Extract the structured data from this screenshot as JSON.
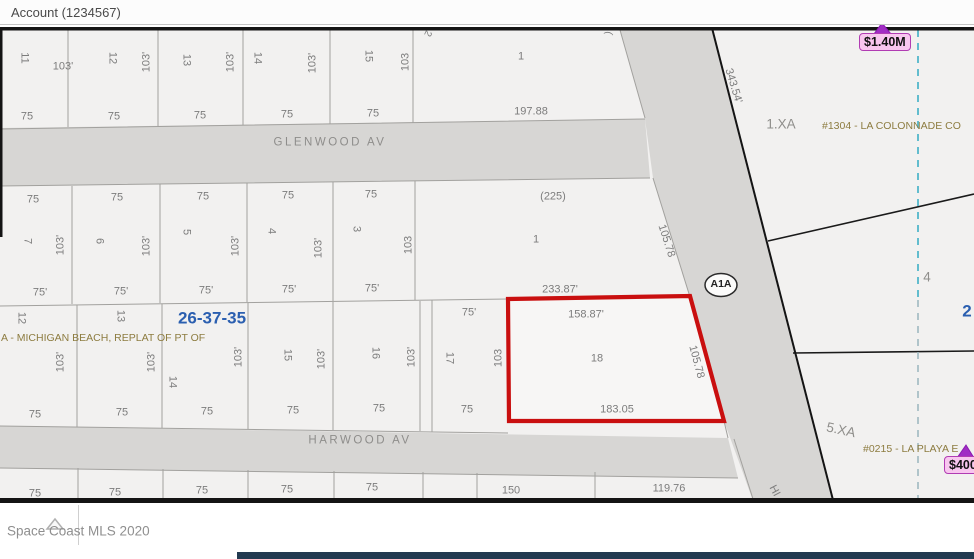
{
  "header": {
    "account_label": "Account (1234567)"
  },
  "footer": {
    "watermark": "Space Coast MLS 2020"
  },
  "map": {
    "shield_label": "A1A",
    "price_markers": [
      {
        "label": "$1.40M"
      },
      {
        "label": "$400"
      }
    ],
    "colors": {
      "parcel_highlight": "#c90f0f",
      "section_blue": "#2b5fb0",
      "plat_olive": "#8d7c40",
      "marker_pink": "#f8c6ef",
      "marker_border": "#b13cb3",
      "road_gray": "#d7d6d4",
      "navy_bar": "#223a50",
      "dashed_line_teal": "#4aafc0"
    },
    "highlighted_parcel": {
      "lot": "18",
      "front": "158.87'",
      "rear": "183.05",
      "side_east": "105.78",
      "side_west": "103"
    },
    "labels": [
      {
        "t": "11",
        "x": 24,
        "y": 58,
        "r": 90
      },
      {
        "t": "12",
        "x": 112,
        "y": 58,
        "r": 90
      },
      {
        "t": "13",
        "x": 186,
        "y": 60,
        "r": 90
      },
      {
        "t": "14",
        "x": 257,
        "y": 58,
        "r": 90
      },
      {
        "t": "15",
        "x": 368,
        "y": 56,
        "r": 90
      },
      {
        "t": "1",
        "x": 521,
        "y": 57
      },
      {
        "t": "103'",
        "x": 63,
        "y": 67
      },
      {
        "t": "103'",
        "x": 147,
        "y": 62,
        "r": -90
      },
      {
        "t": "103'",
        "x": 231,
        "y": 62,
        "r": -90
      },
      {
        "t": "103'",
        "x": 313,
        "y": 63,
        "r": -90
      },
      {
        "t": "103",
        "x": 406,
        "y": 62,
        "r": -90
      },
      {
        "t": "75",
        "x": 27,
        "y": 117
      },
      {
        "t": "75",
        "x": 114,
        "y": 117
      },
      {
        "t": "75",
        "x": 200,
        "y": 116
      },
      {
        "t": "75",
        "x": 287,
        "y": 115
      },
      {
        "t": "75",
        "x": 373,
        "y": 114
      },
      {
        "t": "197.88",
        "x": 531,
        "y": 112
      },
      {
        "t": "2",
        "x": 427,
        "y": 33,
        "r": 115,
        "c": "cut"
      },
      {
        "t": "(",
        "x": 608,
        "y": 33,
        "r": 100,
        "c": "cut"
      },
      {
        "t": "GLENWOOD AV",
        "x": 330,
        "y": 143,
        "c": "street"
      },
      {
        "t": "75",
        "x": 33,
        "y": 200
      },
      {
        "t": "75",
        "x": 117,
        "y": 198
      },
      {
        "t": "75",
        "x": 203,
        "y": 197
      },
      {
        "t": "75",
        "x": 288,
        "y": 196
      },
      {
        "t": "75",
        "x": 371,
        "y": 195
      },
      {
        "t": "(225)",
        "x": 553,
        "y": 197
      },
      {
        "t": "7",
        "x": 27,
        "y": 241,
        "r": 90
      },
      {
        "t": "6",
        "x": 99,
        "y": 241,
        "r": 90
      },
      {
        "t": "5",
        "x": 186,
        "y": 232,
        "r": 90
      },
      {
        "t": "4",
        "x": 271,
        "y": 231,
        "r": 90
      },
      {
        "t": "3",
        "x": 356,
        "y": 229,
        "r": 90
      },
      {
        "t": "1",
        "x": 536,
        "y": 240
      },
      {
        "t": "103'",
        "x": 61,
        "y": 245,
        "r": -90
      },
      {
        "t": "103'",
        "x": 147,
        "y": 246,
        "r": -90
      },
      {
        "t": "103'",
        "x": 236,
        "y": 246,
        "r": -90
      },
      {
        "t": "103'",
        "x": 319,
        "y": 248,
        "r": -90
      },
      {
        "t": "103",
        "x": 409,
        "y": 245,
        "r": -90
      },
      {
        "t": "75'",
        "x": 40,
        "y": 293
      },
      {
        "t": "75'",
        "x": 121,
        "y": 292
      },
      {
        "t": "75'",
        "x": 206,
        "y": 291
      },
      {
        "t": "75'",
        "x": 289,
        "y": 290
      },
      {
        "t": "75'",
        "x": 372,
        "y": 289
      },
      {
        "t": "233.87'",
        "x": 560,
        "y": 290
      },
      {
        "t": "105.78",
        "x": 666,
        "y": 241,
        "r": 72
      },
      {
        "t": "75'",
        "x": 469,
        "y": 313
      },
      {
        "t": "12",
        "x": 21,
        "y": 318,
        "r": 90
      },
      {
        "t": "13",
        "x": 120,
        "y": 316,
        "r": 90
      },
      {
        "t": "14",
        "x": 172,
        "y": 382,
        "r": 90
      },
      {
        "t": "15",
        "x": 287,
        "y": 355,
        "r": 90
      },
      {
        "t": "16",
        "x": 375,
        "y": 353,
        "r": 90
      },
      {
        "t": "17",
        "x": 449,
        "y": 358,
        "r": 90
      },
      {
        "t": "103'",
        "x": 61,
        "y": 362,
        "r": -90
      },
      {
        "t": "103'",
        "x": 152,
        "y": 362,
        "r": -90
      },
      {
        "t": "103'",
        "x": 239,
        "y": 357,
        "r": -90
      },
      {
        "t": "103'",
        "x": 322,
        "y": 359,
        "r": -90
      },
      {
        "t": "103'",
        "x": 412,
        "y": 357,
        "r": -90
      },
      {
        "t": "103",
        "x": 499,
        "y": 358,
        "r": -90
      },
      {
        "t": "26-37-35",
        "x": 212,
        "y": 318,
        "c": "section"
      },
      {
        "t": "A - MICHIGAN BEACH, REPLAT OF PT OF",
        "x": 1,
        "y": 338,
        "c": "plat",
        "a": "l"
      },
      {
        "t": "158.87'",
        "x": 586,
        "y": 315
      },
      {
        "t": "18",
        "x": 597,
        "y": 359
      },
      {
        "t": "183.05",
        "x": 617,
        "y": 410
      },
      {
        "t": "105.78",
        "x": 696,
        "y": 362,
        "r": 75
      },
      {
        "t": "75",
        "x": 35,
        "y": 415
      },
      {
        "t": "75",
        "x": 122,
        "y": 413
      },
      {
        "t": "75",
        "x": 207,
        "y": 412
      },
      {
        "t": "75",
        "x": 293,
        "y": 411
      },
      {
        "t": "75",
        "x": 379,
        "y": 409
      },
      {
        "t": "75",
        "x": 467,
        "y": 410
      },
      {
        "t": "HARWOOD AV",
        "x": 360,
        "y": 441,
        "c": "street"
      },
      {
        "t": "75",
        "x": 35,
        "y": 494
      },
      {
        "t": "75",
        "x": 115,
        "y": 493
      },
      {
        "t": "75",
        "x": 202,
        "y": 491
      },
      {
        "t": "75",
        "x": 287,
        "y": 490
      },
      {
        "t": "75",
        "x": 372,
        "y": 488
      },
      {
        "t": "150",
        "x": 511,
        "y": 491
      },
      {
        "t": "119.76",
        "x": 669,
        "y": 489
      },
      {
        "t": "343.54'",
        "x": 733,
        "y": 86,
        "r": 73
      },
      {
        "t": "1.XA",
        "x": 781,
        "y": 124,
        "c": "parcelname"
      },
      {
        "t": "#1304 - LA COLONNADE CO",
        "x": 822,
        "y": 126,
        "c": "plat",
        "a": "l"
      },
      {
        "t": "4",
        "x": 927,
        "y": 277,
        "c": "parcelname"
      },
      {
        "t": "2",
        "x": 967,
        "y": 311,
        "c": "section"
      },
      {
        "t": "5.XA",
        "x": 841,
        "y": 430,
        "r": 12,
        "c": "parcelname"
      },
      {
        "t": "#0215 - LA PLAYA E",
        "x": 863,
        "y": 449,
        "c": "plat",
        "a": "l"
      },
      {
        "t": "HI",
        "x": 774,
        "y": 491,
        "r": 62
      }
    ]
  }
}
